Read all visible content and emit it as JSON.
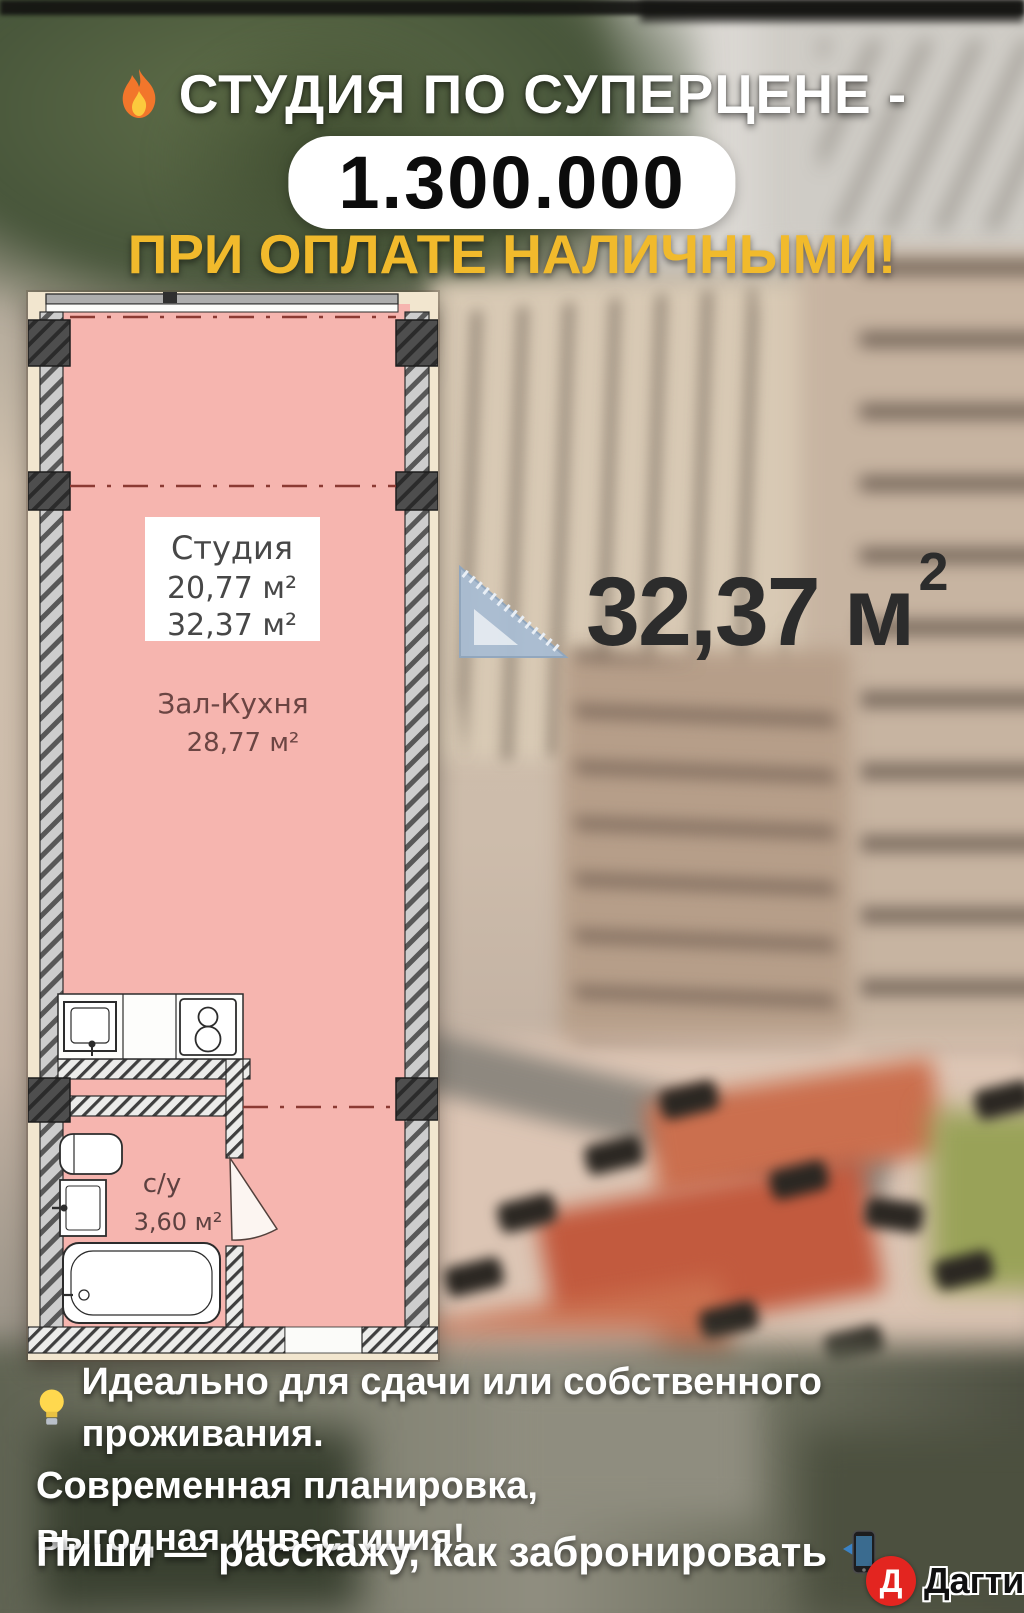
{
  "header": {
    "fire_icon": "🔥",
    "title": "СТУДИЯ ПО СУПЕРЦЕНЕ -",
    "price": "1.300.000",
    "subtitle": "ПРИ ОПЛАТЕ НАЛИЧНЫМИ!"
  },
  "floor_plan": {
    "label_box": {
      "title": "Студия",
      "living_area": "20,77 м²",
      "total_area": "32,37 м²"
    },
    "room": {
      "name": "Зал-Кухня",
      "area": "28,77 м²"
    },
    "bathroom": {
      "name": "с/у",
      "area": "3,60 м²"
    }
  },
  "area_badge": {
    "value": "32,37 м",
    "sup": "2",
    "icon": "set-square-ruler"
  },
  "benefits": {
    "bulb_icon": "💡",
    "line1": "Идеально для сдачи или собственного проживания.",
    "line2": "Современная планировка,",
    "line3": "выгодная инвестиция!"
  },
  "cta": {
    "text": "Пиши — расскажу, как забронировать",
    "phone_icon": "📲"
  },
  "watermark": {
    "initial": "Д",
    "name": "Дагти"
  },
  "colors": {
    "accent_yellow": "#f1ba2c",
    "plan_pink": "#f6b5af",
    "dash_maroon": "#8b3a33",
    "price_text": "#0c0c0c",
    "area_text": "#2c2c2c",
    "watermark_red": "#e32520"
  }
}
